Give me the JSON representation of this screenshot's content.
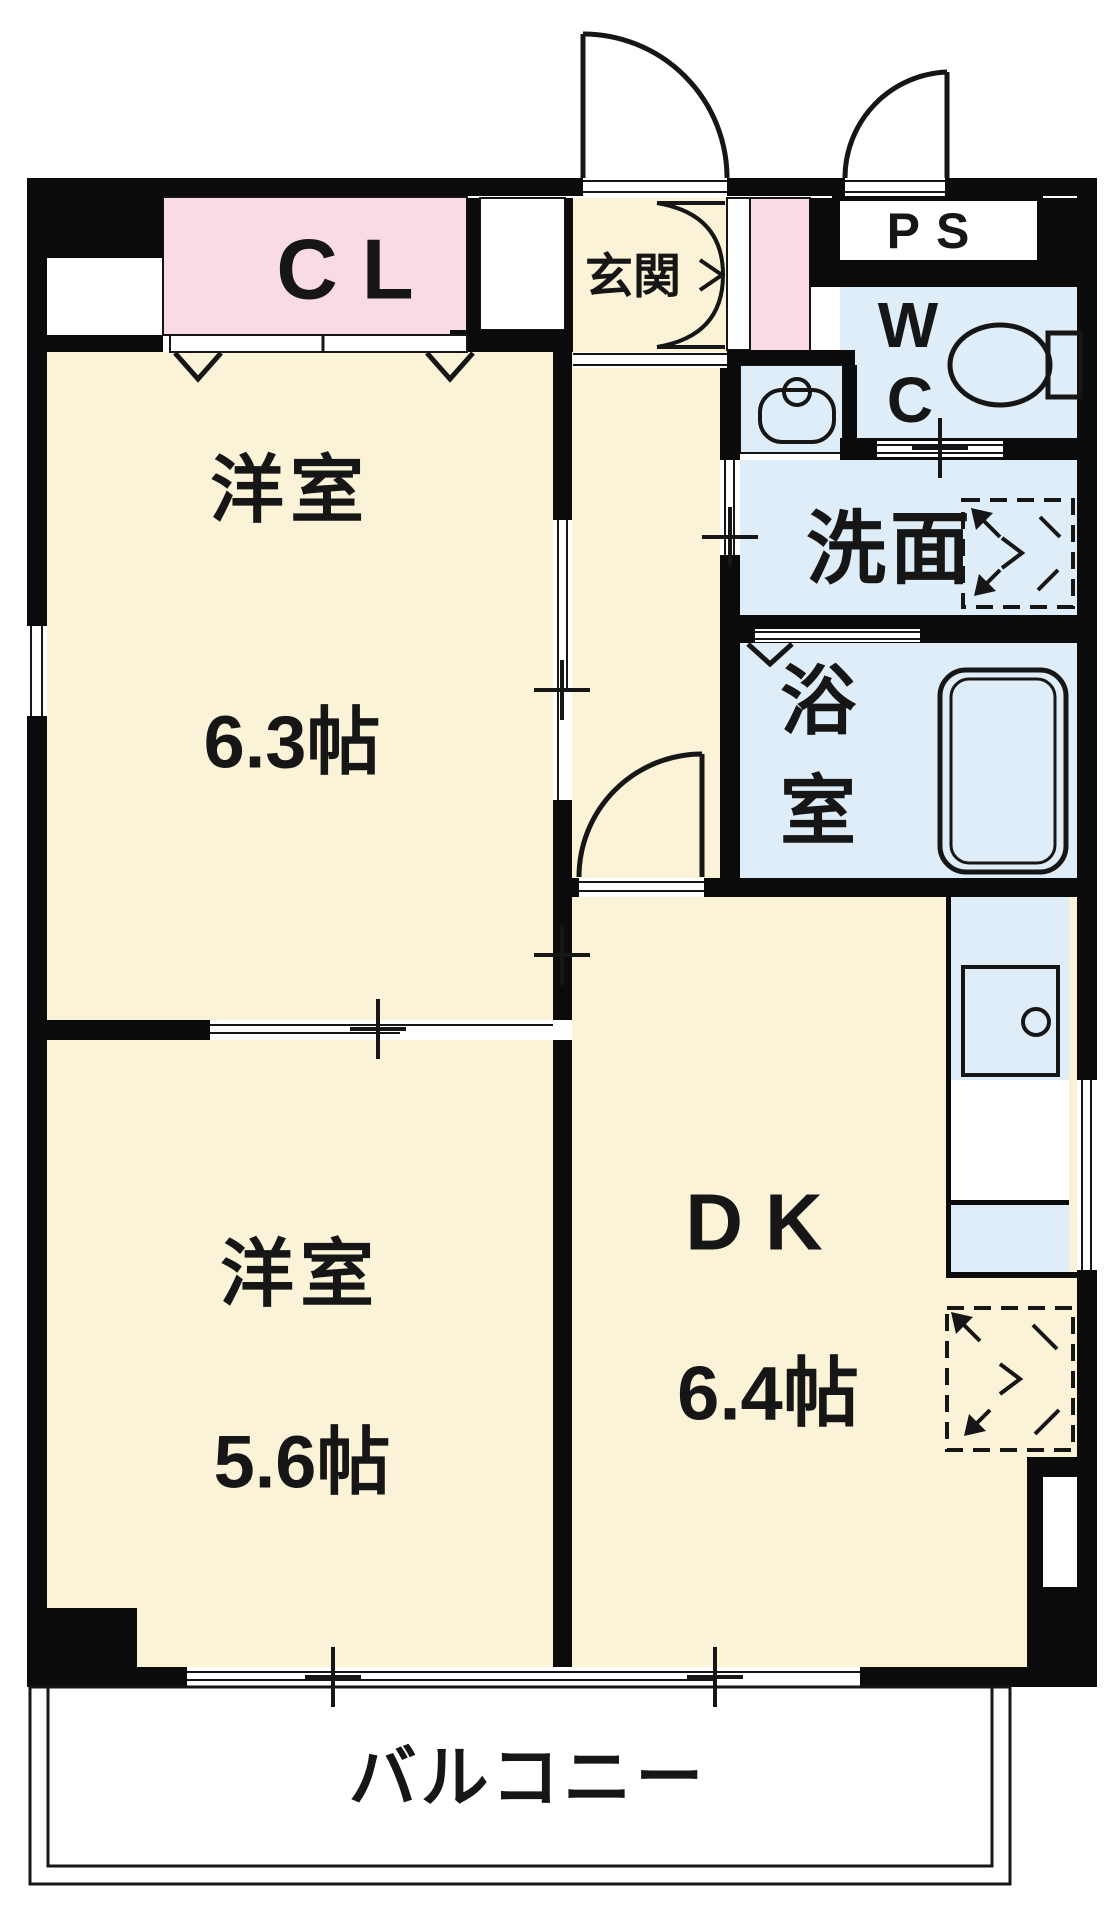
{
  "plan": {
    "closet_label": "CL",
    "entrance_label": "玄関",
    "pipe_space_label": "PS",
    "wc_line1": "W",
    "wc_line2": "C",
    "washroom_label": "洗面",
    "bathroom_char1": "浴",
    "bathroom_char2": "室",
    "western_room1_label": "洋室",
    "western_room1_size": "6.3帖",
    "western_room2_label": "洋室",
    "western_room2_size": "5.6帖",
    "dk_label": "DK",
    "dk_size": "6.4帖",
    "balcony_label": "バルコニー"
  },
  "colors": {
    "room_cream": "#FAF3D8",
    "closet_pink": "#F8DBE6",
    "wet_area_blue": "#DEEDF8",
    "wall_black": "#0B0B0B",
    "background": "#FFFFFF"
  }
}
